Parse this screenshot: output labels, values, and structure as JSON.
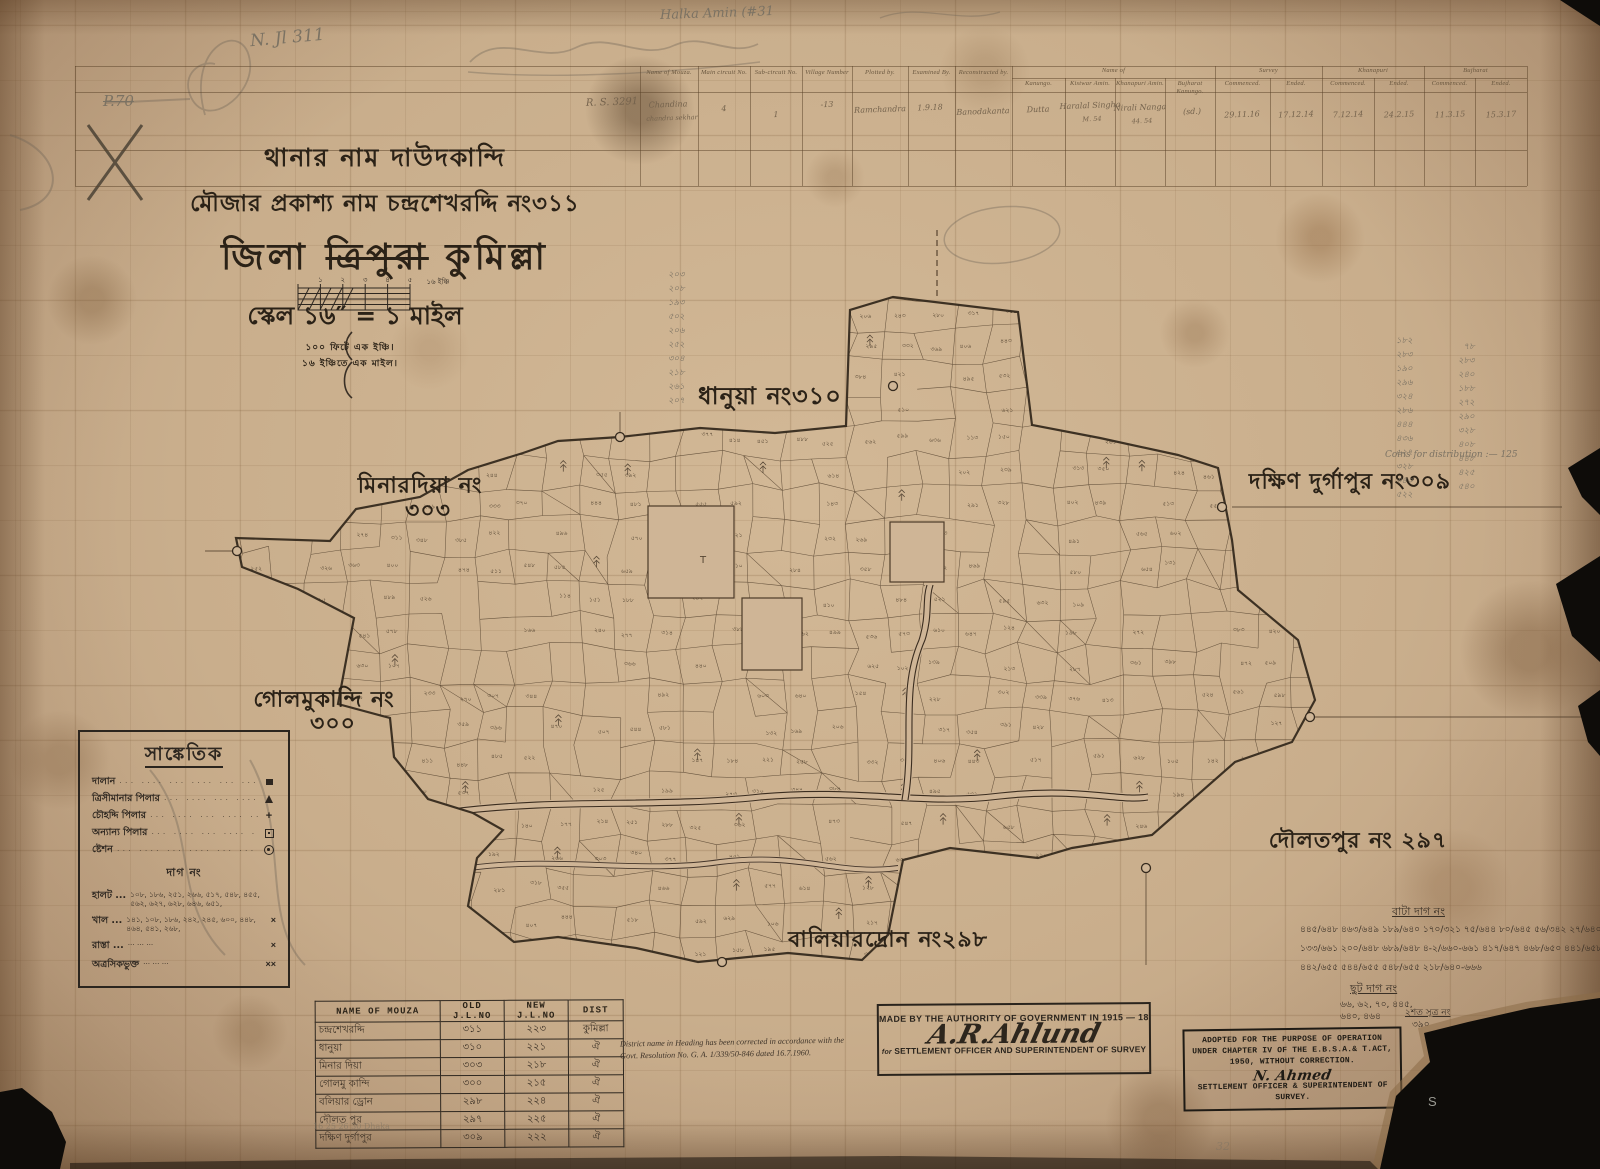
{
  "marginalia": {
    "p70": "P.70",
    "jl_note": "N. Jl  311",
    "halka_note": "Halka Amin (#31",
    "distribution_note": "Coins for distribution :— 125",
    "printers_row": "16        25        26        30   Dhaka",
    "page_pencil": "32",
    "s_mark": "S"
  },
  "survey_form": {
    "ref_no": "R. S. 3291",
    "columns": [
      "Name of Mouza.",
      "Main circuit No.",
      "Sub-circuit No.",
      "Village Number",
      "Plotted by.",
      "Examined By.",
      "Reconstructed by.",
      "Kanungo.",
      "Kistwar Amin.",
      "Khanapuri Amin.",
      "Bujharat Kanungo.",
      "Commenced.",
      "Ended.",
      "Commenced.",
      "Ended.",
      "Commenced.",
      "Ended."
    ],
    "groups": [
      "Name of",
      "Survey",
      "Khanapuri",
      "Bujharat"
    ],
    "entries": [
      "Chandina",
      "chandra sekhar",
      "4",
      "1",
      "-13",
      "Ramchandra",
      "1.9.18",
      "Banodakanta",
      "Dutta",
      "Haralal Singha",
      "M. 54",
      "Nirali Nanga",
      "44. 54",
      "(sd.)",
      "29.11.16",
      "17.12.14",
      "7.12.14",
      "24.2.15",
      "11.3.15",
      "15.3.17"
    ]
  },
  "title_block": {
    "line1": "থানার নাম দাউদকান্দি",
    "line2": "মৌজার প্রকাশ্য নাম চন্দ্রশেখরদ্দি নং৩১১",
    "district_prefix": "জিলা",
    "district_struck": "ত্রিপুরা",
    "district_current": "কুমিল্লা",
    "scale_line": "স্কেল ১৬″ = ১ মাইল",
    "scale_note1": "১০০ ফিটে এক ইঞ্চি।",
    "scale_note2": "১৬ ইঞ্চিতে এক মাইল।",
    "scale_bar_ticks": [
      "১",
      "২",
      "৩",
      "৪",
      "৫"
    ],
    "scale_bar_right_label": "১৬ ইঞ্চি"
  },
  "map": {
    "region_labels": [
      {
        "text": "ধানুয়া নং৩১০",
        "x": 770,
        "y": 398,
        "s": 24
      },
      {
        "text": "মিনারদিয়া নং",
        "x": 420,
        "y": 487,
        "s": 22
      },
      {
        "text": "৩০৩",
        "x": 428,
        "y": 512,
        "s": 22
      },
      {
        "text": "দক্ষিণ দুর্গাপুর নং৩০৯",
        "x": 1350,
        "y": 483,
        "s": 22
      },
      {
        "text": "গোলমুকান্দি নং",
        "x": 324,
        "y": 701,
        "s": 22
      },
      {
        "text": "৩০০",
        "x": 333,
        "y": 725,
        "s": 22
      },
      {
        "text": "দৌলতপুর নং ২৯৭",
        "x": 1358,
        "y": 842,
        "s": 22
      },
      {
        "text": "বালিয়ারদ্রোন নং২৯৮",
        "x": 888,
        "y": 941,
        "s": 22
      }
    ],
    "blank_plot_mark": "T"
  },
  "legend": {
    "title": "সাঙ্কেতিক",
    "symbol_rows": [
      {
        "label": "দালান",
        "type": "building"
      },
      {
        "label": "ত্রিসীমানার পিলার",
        "type": "triangle"
      },
      {
        "label": "চৌহদ্দি পিলার",
        "type": "plus"
      },
      {
        "label": "অন্যান্য পিলার",
        "type": "sqdot"
      },
      {
        "label": "ষ্টেশন",
        "type": "circledot"
      }
    ],
    "dag_header": "দাগ নং",
    "number_rows": [
      {
        "label": "হালট ...",
        "values": "১০৮, ১৮৬, ২৫১, ২৬৬, ৫১৭, ৫৪৮, ৪৫৫, ৫৬২, ৬২৭, ৬২৮, ৬৪৬, ৬৫১,",
        "sym": ""
      },
      {
        "label": "খাল ...",
        "values": "১৪১, ১০৮, ১৮৬, ২৪২, ২৪৫, ৬০০, ৪৪৮, ৪৬৪, ৫৪১, ২৬৮,",
        "sym": "×"
      },
      {
        "label": "রাস্তা ...",
        "values": "",
        "sym": "×"
      },
      {
        "label": "অত্রসিকভুক্ত",
        "values": "",
        "sym": "××"
      }
    ]
  },
  "mouza_table": {
    "headers": [
      "NAME OF MOUZA",
      "OLD J.L.NO",
      "NEW J.L.NO",
      "DIST"
    ],
    "rows": [
      [
        "চন্দ্রশেখরদ্দি",
        "৩১১",
        "২২৩",
        "কুমিল্লা"
      ],
      [
        "ধানুয়া",
        "৩১০",
        "২২১",
        "ঐ"
      ],
      [
        "মিনার দিয়া",
        "৩০৩",
        "২১৮",
        "ঐ"
      ],
      [
        "গোলমু কান্দি",
        "৩০০",
        "২১৫",
        "ঐ"
      ],
      [
        "বলিয়ার ড্রোন",
        "২৯৮",
        "২২৪",
        "ঐ"
      ],
      [
        "দৌলত পুর",
        "২৯৭",
        "২২৫",
        "ঐ"
      ],
      [
        "দক্ষিণ দুর্গাপুর",
        "৩০৯",
        "২২২",
        "ঐ"
      ]
    ]
  },
  "correction_note": {
    "line1": "District name in Heading has been corrected in accordance with the",
    "line2": "Govt. Resolution No. G. A. 1/339/50-846 dated 16.7.1960."
  },
  "stamps": {
    "left": {
      "line1": "MADE BY THE AUTHORITY OF GOVERNMENT IN 1915 — 18",
      "signature": "A.R.Ahlund",
      "for_word": "for",
      "line2": "SETTLEMENT OFFICER AND SUPERINTENDENT OF SURVEY"
    },
    "right": {
      "line1": "ADOPTED FOR THE PURPOSE OF OPERATION",
      "line2": "UNDER CHAPTER IV OF THE E.B.S.A.& T.ACT,",
      "line3": "1950, WITHOUT CORRECTION.",
      "signature": "N. Ahmed",
      "line4": "SETTLEMENT OFFICER & SUPERINTENDENT OF",
      "line5": "SURVEY."
    }
  },
  "ink_annotations": {
    "bata_header": "বাটা দাগ নং",
    "bata_rows": [
      "৪৪৫/৬৪৮   ৪৬৩/৬৪৯   ১৮৯/৬৪০   ১৭০/৩২১   ৭৫/৬৪৪   ৮০/৬৪৫   ৫৬/৩৪২   ২৭/৬৪০",
      "১৩৩/৬৬১   ২০০/৬৪৮   ৬৮৯/৬৪৮   ৪-২/৬৬০-৬৬১   ৪১৭/৬৪৭   ৪৬৮/৬৫০   ৪৪১/৬৫৮",
      "৪৪২/৬৫৫   ৫৪৪/৬৫৫   ৫৪৮/৬৫৫   ২১৮/৬৪০-৬৬৬"
    ],
    "chhut_header": "ছুট দাগ নং",
    "chhut_rows": [
      "৬৬, ৬২, ৭০, ৪৪৫,",
      "৬৪০, ৪৬৪"
    ],
    "sutra_note": [
      "২শত সূত্র নং",
      "৩৯০"
    ]
  },
  "pencil_numbers": {
    "left_column": [
      "২০৩",
      "২০৮",
      "১৯৩",
      "৫০২",
      "২০৬",
      "২৫২",
      "৩০৪",
      "২১৮",
      "২৬১",
      "২০৭"
    ],
    "right_col_a": [
      "১৮২",
      "২৮৩",
      "১৯০",
      "২৯৬",
      "৩২৪",
      "২৮৬",
      "৪৪৪",
      "৪৩৬",
      "৬২৭",
      "৩২৮",
      "৩৪৩",
      "৫২২"
    ],
    "right_col_b": [
      "৭৮",
      "২৮৩",
      "২৪০",
      "১৮৮",
      "২৭২",
      "২৯০",
      "৩২৮",
      "৪০৮",
      "৪৪৮",
      "৪২৫",
      "৫৪০"
    ]
  }
}
